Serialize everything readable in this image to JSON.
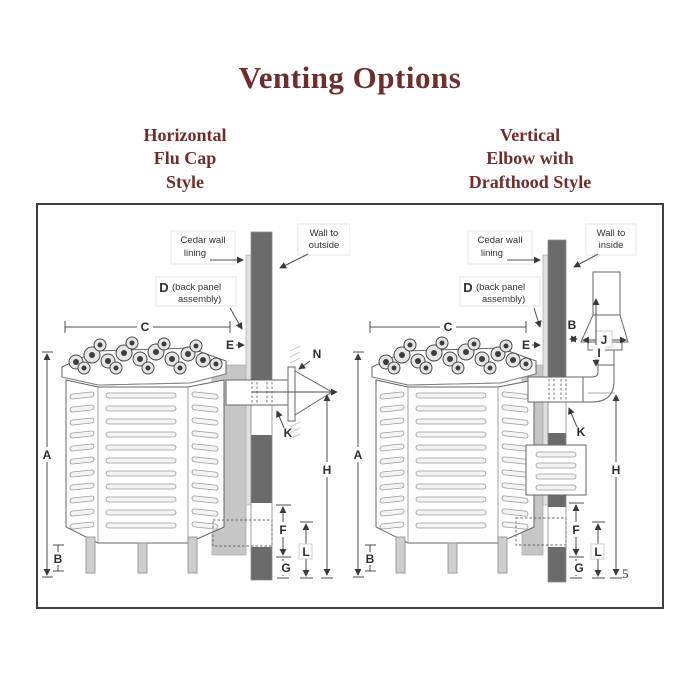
{
  "page": {
    "title": "Venting Options",
    "page_number": "5"
  },
  "colors": {
    "accent": "#6e2e2e",
    "wall": "#6b6b6b",
    "back_panel": "#c6c6c6"
  },
  "left": {
    "subtitle": "Horizontal\nFlu Cap\nStyle",
    "ann": {
      "cedar1": "Cedar wall",
      "cedar2": "lining",
      "wall1": "Wall to",
      "wall2": "outside",
      "d": "D",
      "bp1": "(back panel",
      "bp2": "assembly)"
    },
    "dims": {
      "a": "A",
      "b": "B",
      "c": "C",
      "e": "E",
      "f": "F",
      "g": "G",
      "h": "H",
      "k": "K",
      "l": "L",
      "n": "N"
    }
  },
  "right": {
    "subtitle": "Vertical\nElbow with\nDrafthood Style",
    "ann": {
      "cedar1": "Cedar wall",
      "cedar2": "lining",
      "wall1": "Wall to",
      "wall2": "inside",
      "d": "D",
      "bp1": "(back panel",
      "bp2": "assembly)"
    },
    "dims": {
      "a": "A",
      "b_leg": "B",
      "b_gap": "B",
      "c": "C",
      "e": "E",
      "f": "F",
      "g": "G",
      "h": "H",
      "i": "I",
      "j": "J",
      "k": "K",
      "l": "L"
    }
  }
}
